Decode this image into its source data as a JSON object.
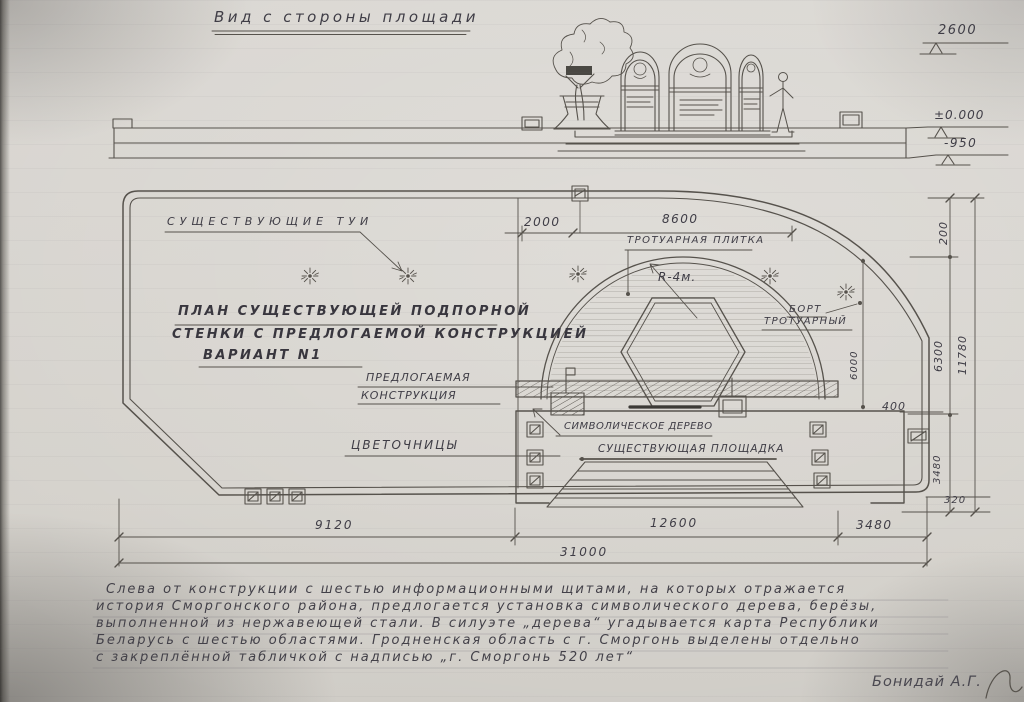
{
  "drawing": {
    "title": "Вид с стороны площади",
    "signature": "Бонидай А.Г.",
    "notes": [
      "Слева от конструкции с шестью информационными щитами, на которых отражается",
      "история Сморгонского района, предлогается установка символического дерева, берёзы,",
      "выполненной из нержавеющей стали. В силуэте „дерева“ угадывается карта Республики",
      "Беларусь с шестью областями. Гродненская область с г. Сморгонь выделены отдельно",
      "с закреплённой табличкой с надписью „г. Сморгонь 520 лет“"
    ]
  },
  "colors": {
    "paper": "#d6d3cd",
    "pencil": "#56524c",
    "graphite_text": "#3f3d46"
  },
  "labels": [
    {
      "n": "label-existing-thujas",
      "t": "СУЩЕСТВУЮЩИЕ ТУИ",
      "x": 167,
      "y": 216,
      "fs": 11,
      "ls": 5
    },
    {
      "n": "label-plan-title-line1",
      "t": "ПЛАН СУЩЕСТВУЮЩЕЙ ПОДПОРНОЙ",
      "x": 178,
      "y": 305,
      "fs": 13,
      "ls": 2.5,
      "fw": 1
    },
    {
      "n": "label-plan-title-line2",
      "t": "СТЕНКИ С ПРЕДЛОГАЕМОЙ КОНСТРУКЦИЕЙ",
      "x": 172,
      "y": 328,
      "fs": 13,
      "ls": 2.5,
      "fw": 1
    },
    {
      "n": "label-plan-title-line3",
      "t": "ВАРИАНТ N1",
      "x": 203,
      "y": 349,
      "fs": 13,
      "ls": 2.5,
      "fw": 1
    },
    {
      "n": "label-sidewalk-tile",
      "t": "ТРОТУАРНАЯ ПЛИТКА",
      "x": 627,
      "y": 236,
      "fs": 10,
      "ls": 1.5
    },
    {
      "n": "label-radius",
      "t": "R-4м.",
      "x": 658,
      "y": 271,
      "fs": 12,
      "ls": 1
    },
    {
      "n": "label-curb-line1",
      "t": "БОРТ",
      "x": 789,
      "y": 305,
      "fs": 10,
      "ls": 1.5
    },
    {
      "n": "label-curb-line2",
      "t": "ТРОТУАРНЫЙ",
      "x": 764,
      "y": 317,
      "fs": 10,
      "ls": 1.5
    },
    {
      "n": "label-proposed-line1",
      "t": "ПРЕДЛОГАЕМАЯ",
      "x": 366,
      "y": 372,
      "fs": 11,
      "ls": 1
    },
    {
      "n": "label-proposed-line2",
      "t": "КОНСТРУКЦИЯ",
      "x": 361,
      "y": 390,
      "fs": 11,
      "ls": 1
    },
    {
      "n": "label-flower-boxes",
      "t": "ЦВЕТОЧНИЦЫ",
      "x": 351,
      "y": 439,
      "fs": 12,
      "ls": 2
    },
    {
      "n": "label-symbolic-tree",
      "t": "СИМВОЛИЧЕСКОЕ ДЕРЕВО",
      "x": 564,
      "y": 422,
      "fs": 10,
      "ls": 0.5
    },
    {
      "n": "label-existing-platform",
      "t": "СУЩЕСТВУЮЩАЯ ПЛОЩАДКА",
      "x": 598,
      "y": 444,
      "fs": 10.5,
      "ls": 1
    },
    {
      "n": "dim-2600",
      "t": "2600",
      "x": 938,
      "y": 24,
      "fs": 13,
      "ls": 1.5
    },
    {
      "n": "dim-level-zero",
      "t": "±0.000",
      "x": 934,
      "y": 109,
      "fs": 12,
      "ls": 1
    },
    {
      "n": "dim-level-950",
      "t": "-950",
      "x": 944,
      "y": 137,
      "fs": 12,
      "ls": 1.5
    },
    {
      "n": "dim-2000",
      "t": "2000",
      "x": 524,
      "y": 216,
      "fs": 12,
      "ls": 1.5
    },
    {
      "n": "dim-8600",
      "t": "8600",
      "x": 662,
      "y": 213,
      "fs": 12,
      "ls": 1.5
    },
    {
      "n": "dim-200",
      "t": "200",
      "x": 938,
      "y": 245,
      "fs": 11,
      "ls": 1,
      "rot": -90
    },
    {
      "n": "dim-6300",
      "t": "6300",
      "x": 933,
      "y": 372,
      "fs": 11,
      "ls": 1,
      "rot": -90
    },
    {
      "n": "dim-11780",
      "t": "11780",
      "x": 957,
      "y": 375,
      "fs": 11,
      "ls": 1,
      "rot": -90
    },
    {
      "n": "dim-6000",
      "t": "6000",
      "x": 850,
      "y": 380,
      "fs": 10,
      "ls": 1,
      "rot": -90
    },
    {
      "n": "dim-400",
      "t": "400",
      "x": 882,
      "y": 401,
      "fs": 11,
      "ls": 1
    },
    {
      "n": "dim-3480-right",
      "t": "3480",
      "x": 933,
      "y": 484,
      "fs": 10,
      "ls": 1,
      "rot": -90
    },
    {
      "n": "dim-320",
      "t": "320",
      "x": 944,
      "y": 496,
      "fs": 10,
      "ls": 1
    },
    {
      "n": "dim-9120",
      "t": "9120",
      "x": 315,
      "y": 519,
      "fs": 12,
      "ls": 2
    },
    {
      "n": "dim-12600",
      "t": "12600",
      "x": 650,
      "y": 517,
      "fs": 12,
      "ls": 2
    },
    {
      "n": "dim-3480-bottom",
      "t": "3480",
      "x": 856,
      "y": 519,
      "fs": 12,
      "ls": 1.5
    },
    {
      "n": "dim-31000",
      "t": "31000",
      "x": 560,
      "y": 546,
      "fs": 12,
      "ls": 2
    }
  ]
}
